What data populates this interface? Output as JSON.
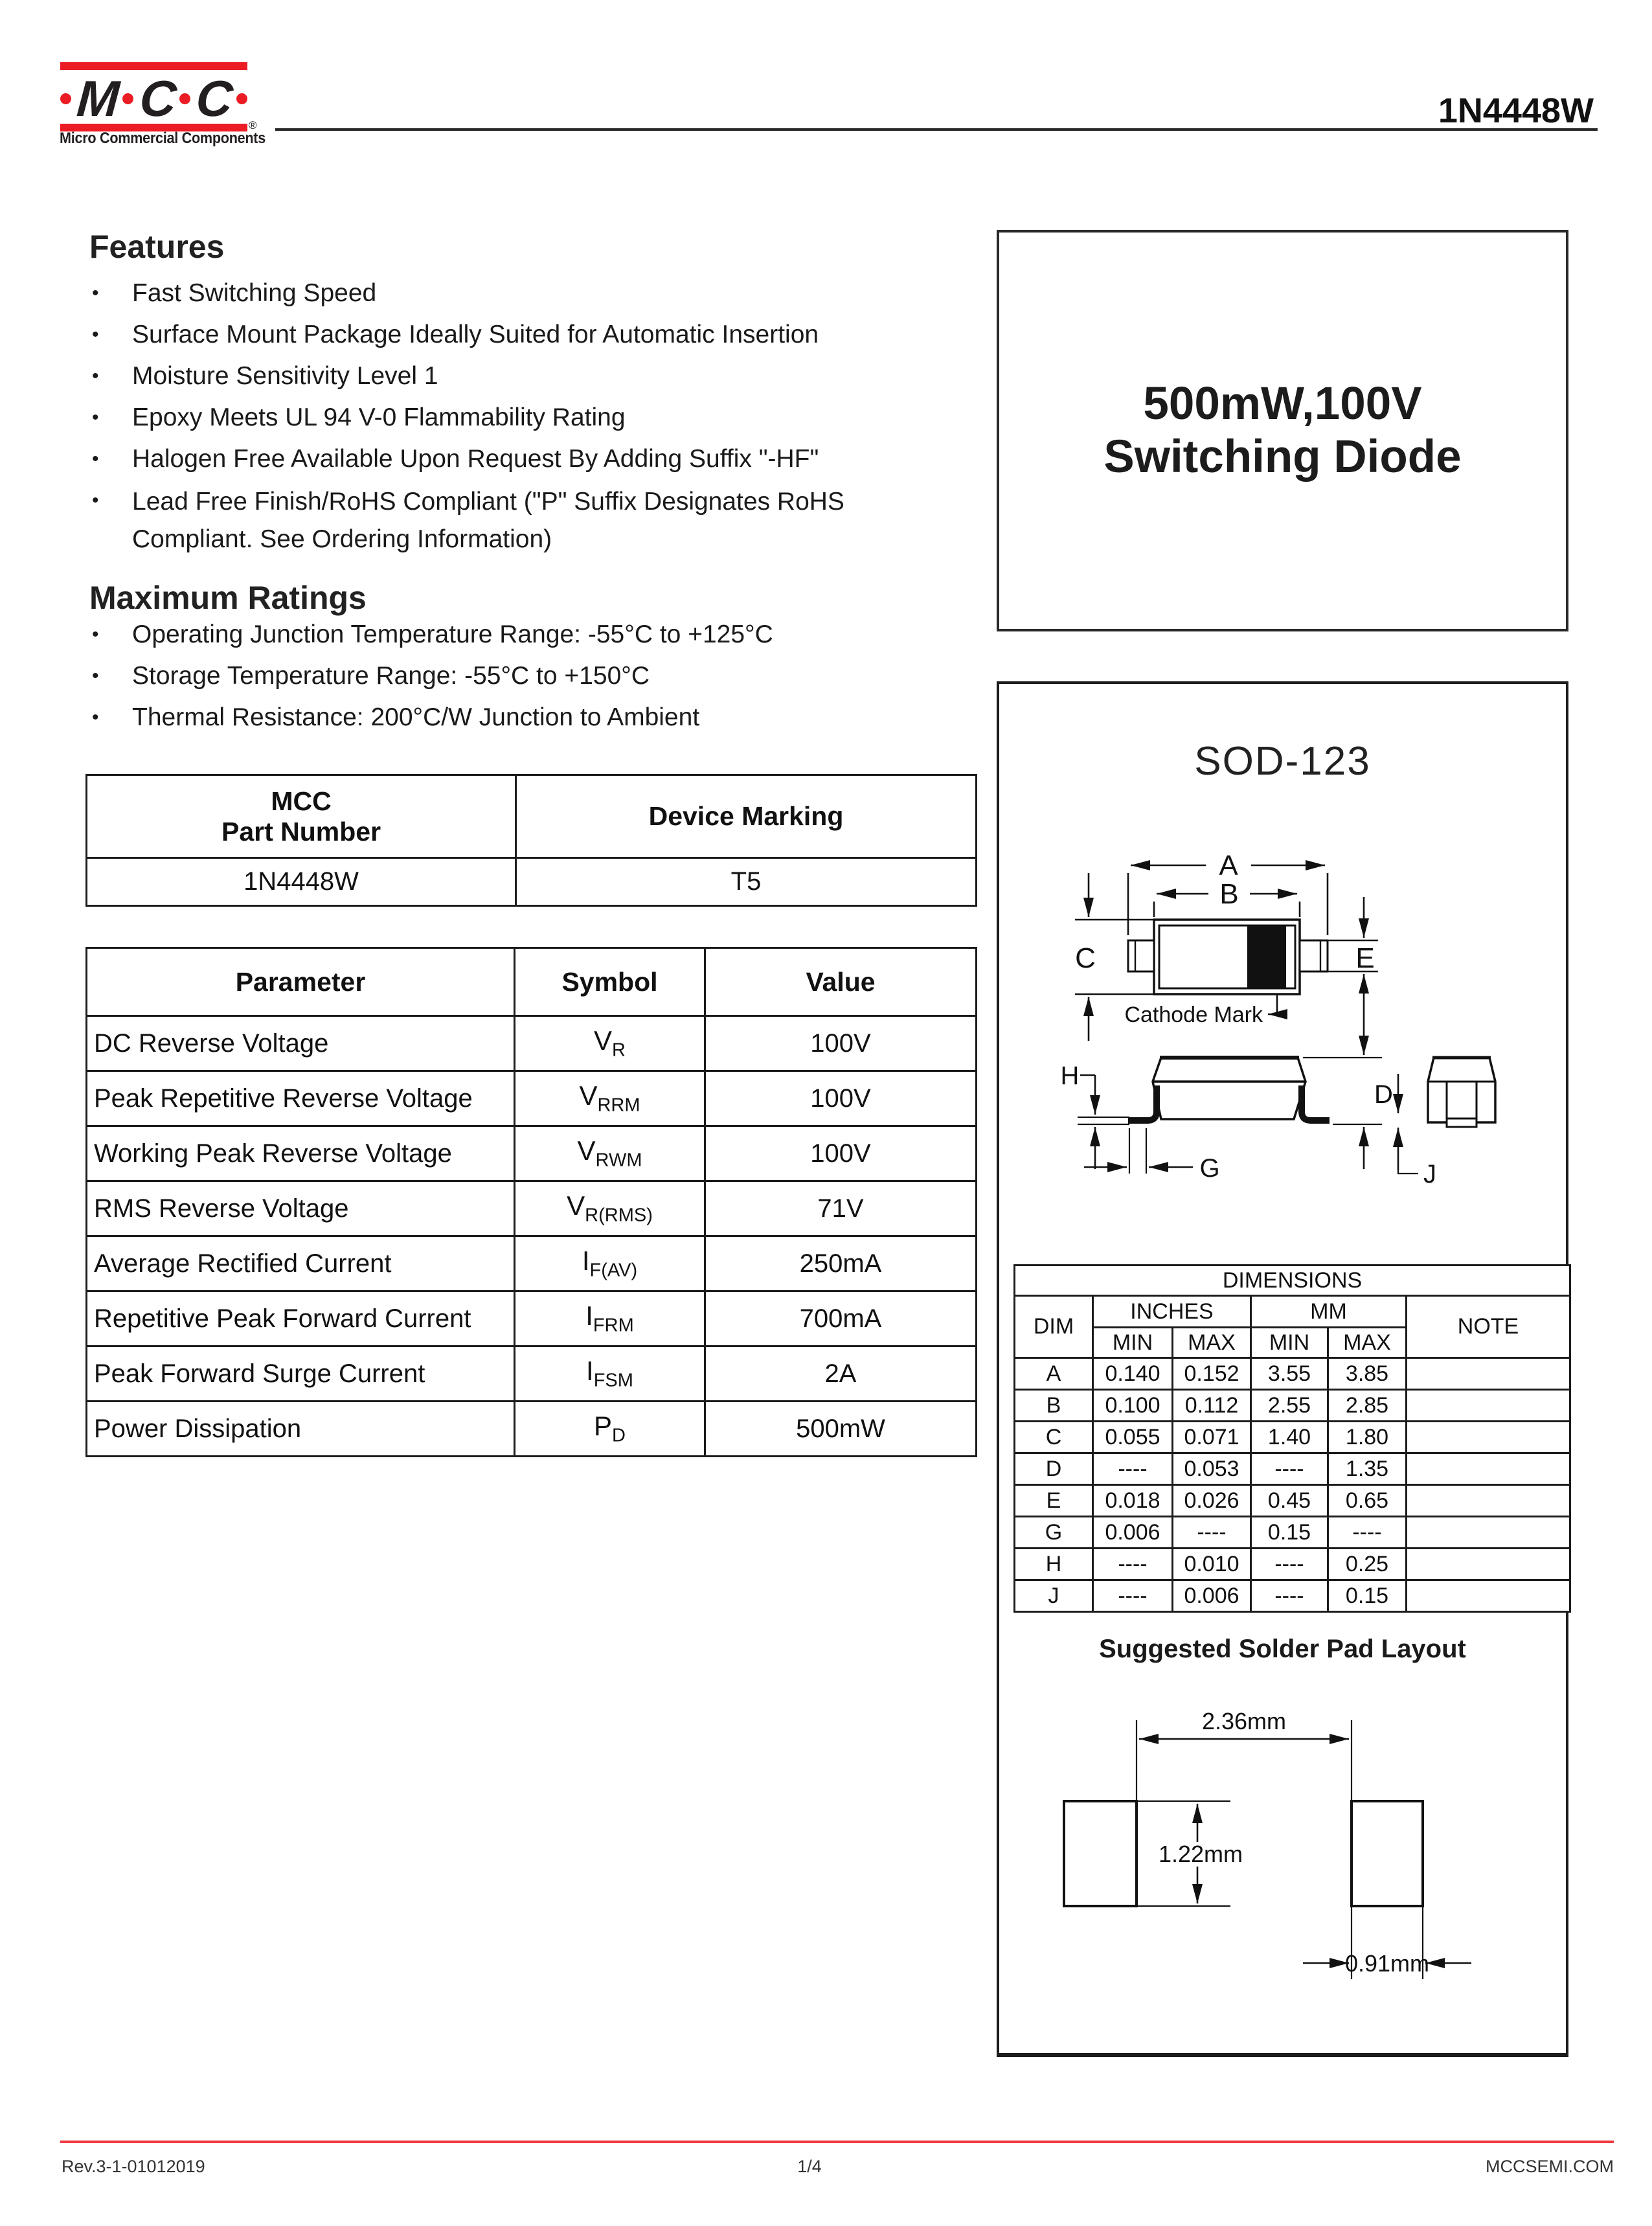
{
  "header": {
    "part_number": "1N4448W"
  },
  "logo": {
    "letters": [
      "M",
      "C",
      "C"
    ],
    "registered": "®",
    "tagline": "Micro Commercial Components"
  },
  "bullet": "•",
  "features": {
    "title": "Features",
    "items": [
      "Fast Switching Speed",
      "Surface Mount Package Ideally Suited for Automatic Insertion",
      "Moisture Sensitivity Level 1",
      "Epoxy Meets UL 94 V-0 Flammability Rating",
      "Halogen Free Available Upon Request By Adding Suffix \"-HF\"",
      "Lead Free Finish/RoHS Compliant (\"P\" Suffix Designates RoHS Compliant. See Ordering Information)"
    ]
  },
  "max_ratings": {
    "title": "Maximum Ratings",
    "items": [
      "Operating Junction Temperature Range: -55°C to +125°C",
      "Storage Temperature Range: -55°C to +150°C",
      "Thermal Resistance: 200°C/W Junction to Ambient"
    ]
  },
  "part_table": {
    "col1_line1": "MCC",
    "col1_line2": "Part Number",
    "col2": "Device Marking",
    "part": "1N4448W",
    "marking": "T5"
  },
  "param_table": {
    "headers": [
      "Parameter",
      "Symbol",
      "Value"
    ],
    "rows": [
      {
        "param": "DC Reverse Voltage",
        "sym_base": "V",
        "sym_sub": "R",
        "value": "100V"
      },
      {
        "param": "Peak Repetitive Reverse Voltage",
        "sym_base": "V",
        "sym_sub": "RRM",
        "value": "100V"
      },
      {
        "param": "Working Peak Reverse Voltage",
        "sym_base": "V",
        "sym_sub": "RWM",
        "value": "100V"
      },
      {
        "param": "RMS Reverse Voltage",
        "sym_base": "V",
        "sym_sub": "R(RMS)",
        "value": "71V"
      },
      {
        "param": "Average Rectified Current",
        "sym_base": "I",
        "sym_sub": "F(AV)",
        "value": "250mA"
      },
      {
        "param": "Repetitive Peak Forward Current",
        "sym_base": "I",
        "sym_sub": "FRM",
        "value": "700mA"
      },
      {
        "param": "Peak Forward Surge Current",
        "sym_base": "I",
        "sym_sub": "FSM",
        "value": "2A"
      },
      {
        "param": "Power Dissipation",
        "sym_base": "P",
        "sym_sub": "D",
        "value": "500mW"
      }
    ]
  },
  "title_box": {
    "line1": "500mW,100V",
    "line2": "Switching Diode"
  },
  "package": {
    "name": "SOD-123",
    "cathode_label": "Cathode Mark",
    "labels": {
      "A": "A",
      "B": "B",
      "C": "C",
      "D": "D",
      "E": "E",
      "G": "G",
      "H": "H",
      "J": "J"
    }
  },
  "dimensions": {
    "title": "DIMENSIONS",
    "col_dim": "DIM",
    "col_inches": "INCHES",
    "col_mm": "MM",
    "col_note": "NOTE",
    "min": "MIN",
    "max": "MAX",
    "rows": [
      {
        "dim": "A",
        "in_min": "0.140",
        "in_max": "0.152",
        "mm_min": "3.55",
        "mm_max": "3.85",
        "note": ""
      },
      {
        "dim": "B",
        "in_min": "0.100",
        "in_max": "0.112",
        "mm_min": "2.55",
        "mm_max": "2.85",
        "note": ""
      },
      {
        "dim": "C",
        "in_min": "0.055",
        "in_max": "0.071",
        "mm_min": "1.40",
        "mm_max": "1.80",
        "note": ""
      },
      {
        "dim": "D",
        "in_min": "----",
        "in_max": "0.053",
        "mm_min": "----",
        "mm_max": "1.35",
        "note": ""
      },
      {
        "dim": "E",
        "in_min": "0.018",
        "in_max": "0.026",
        "mm_min": "0.45",
        "mm_max": "0.65",
        "note": ""
      },
      {
        "dim": "G",
        "in_min": "0.006",
        "in_max": "----",
        "mm_min": "0.15",
        "mm_max": "----",
        "note": ""
      },
      {
        "dim": "H",
        "in_min": "----",
        "in_max": "0.010",
        "mm_min": "----",
        "mm_max": "0.25",
        "note": ""
      },
      {
        "dim": "J",
        "in_min": "----",
        "in_max": "0.006",
        "mm_min": "----",
        "mm_max": "0.15",
        "note": ""
      }
    ]
  },
  "solder": {
    "title": "Suggested Solder Pad Layout",
    "dim_gap": "2.36mm",
    "dim_height": "1.22mm",
    "dim_width": "0.91mm"
  },
  "footer": {
    "rev": "Rev.3-1-01012019",
    "page": "1/4",
    "site": "MCCSEMI.COM"
  }
}
